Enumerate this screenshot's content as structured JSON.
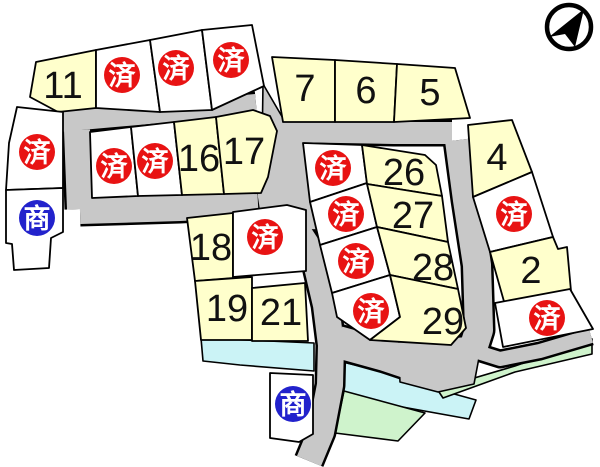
{
  "map": {
    "marks": {
      "sold": "済",
      "commercial": "商"
    },
    "lots": {
      "l2": "2",
      "l4": "4",
      "l5": "5",
      "l6": "6",
      "l7": "7",
      "l11": "11",
      "l16": "16",
      "l17": "17",
      "l18": "18",
      "l19": "19",
      "l21": "21",
      "l26": "26",
      "l27": "27",
      "l28": "28",
      "l29": "29"
    },
    "colors": {
      "available_lot": "#FFFFCC",
      "sold_lot": "#FFFFFF",
      "road": "#C8C8C8",
      "waterway": "#CBF3F6",
      "green_space": "#CFF3CC",
      "sold_badge": "#E81313",
      "commercial_badge": "#2222CC",
      "outline": "#000000"
    }
  }
}
